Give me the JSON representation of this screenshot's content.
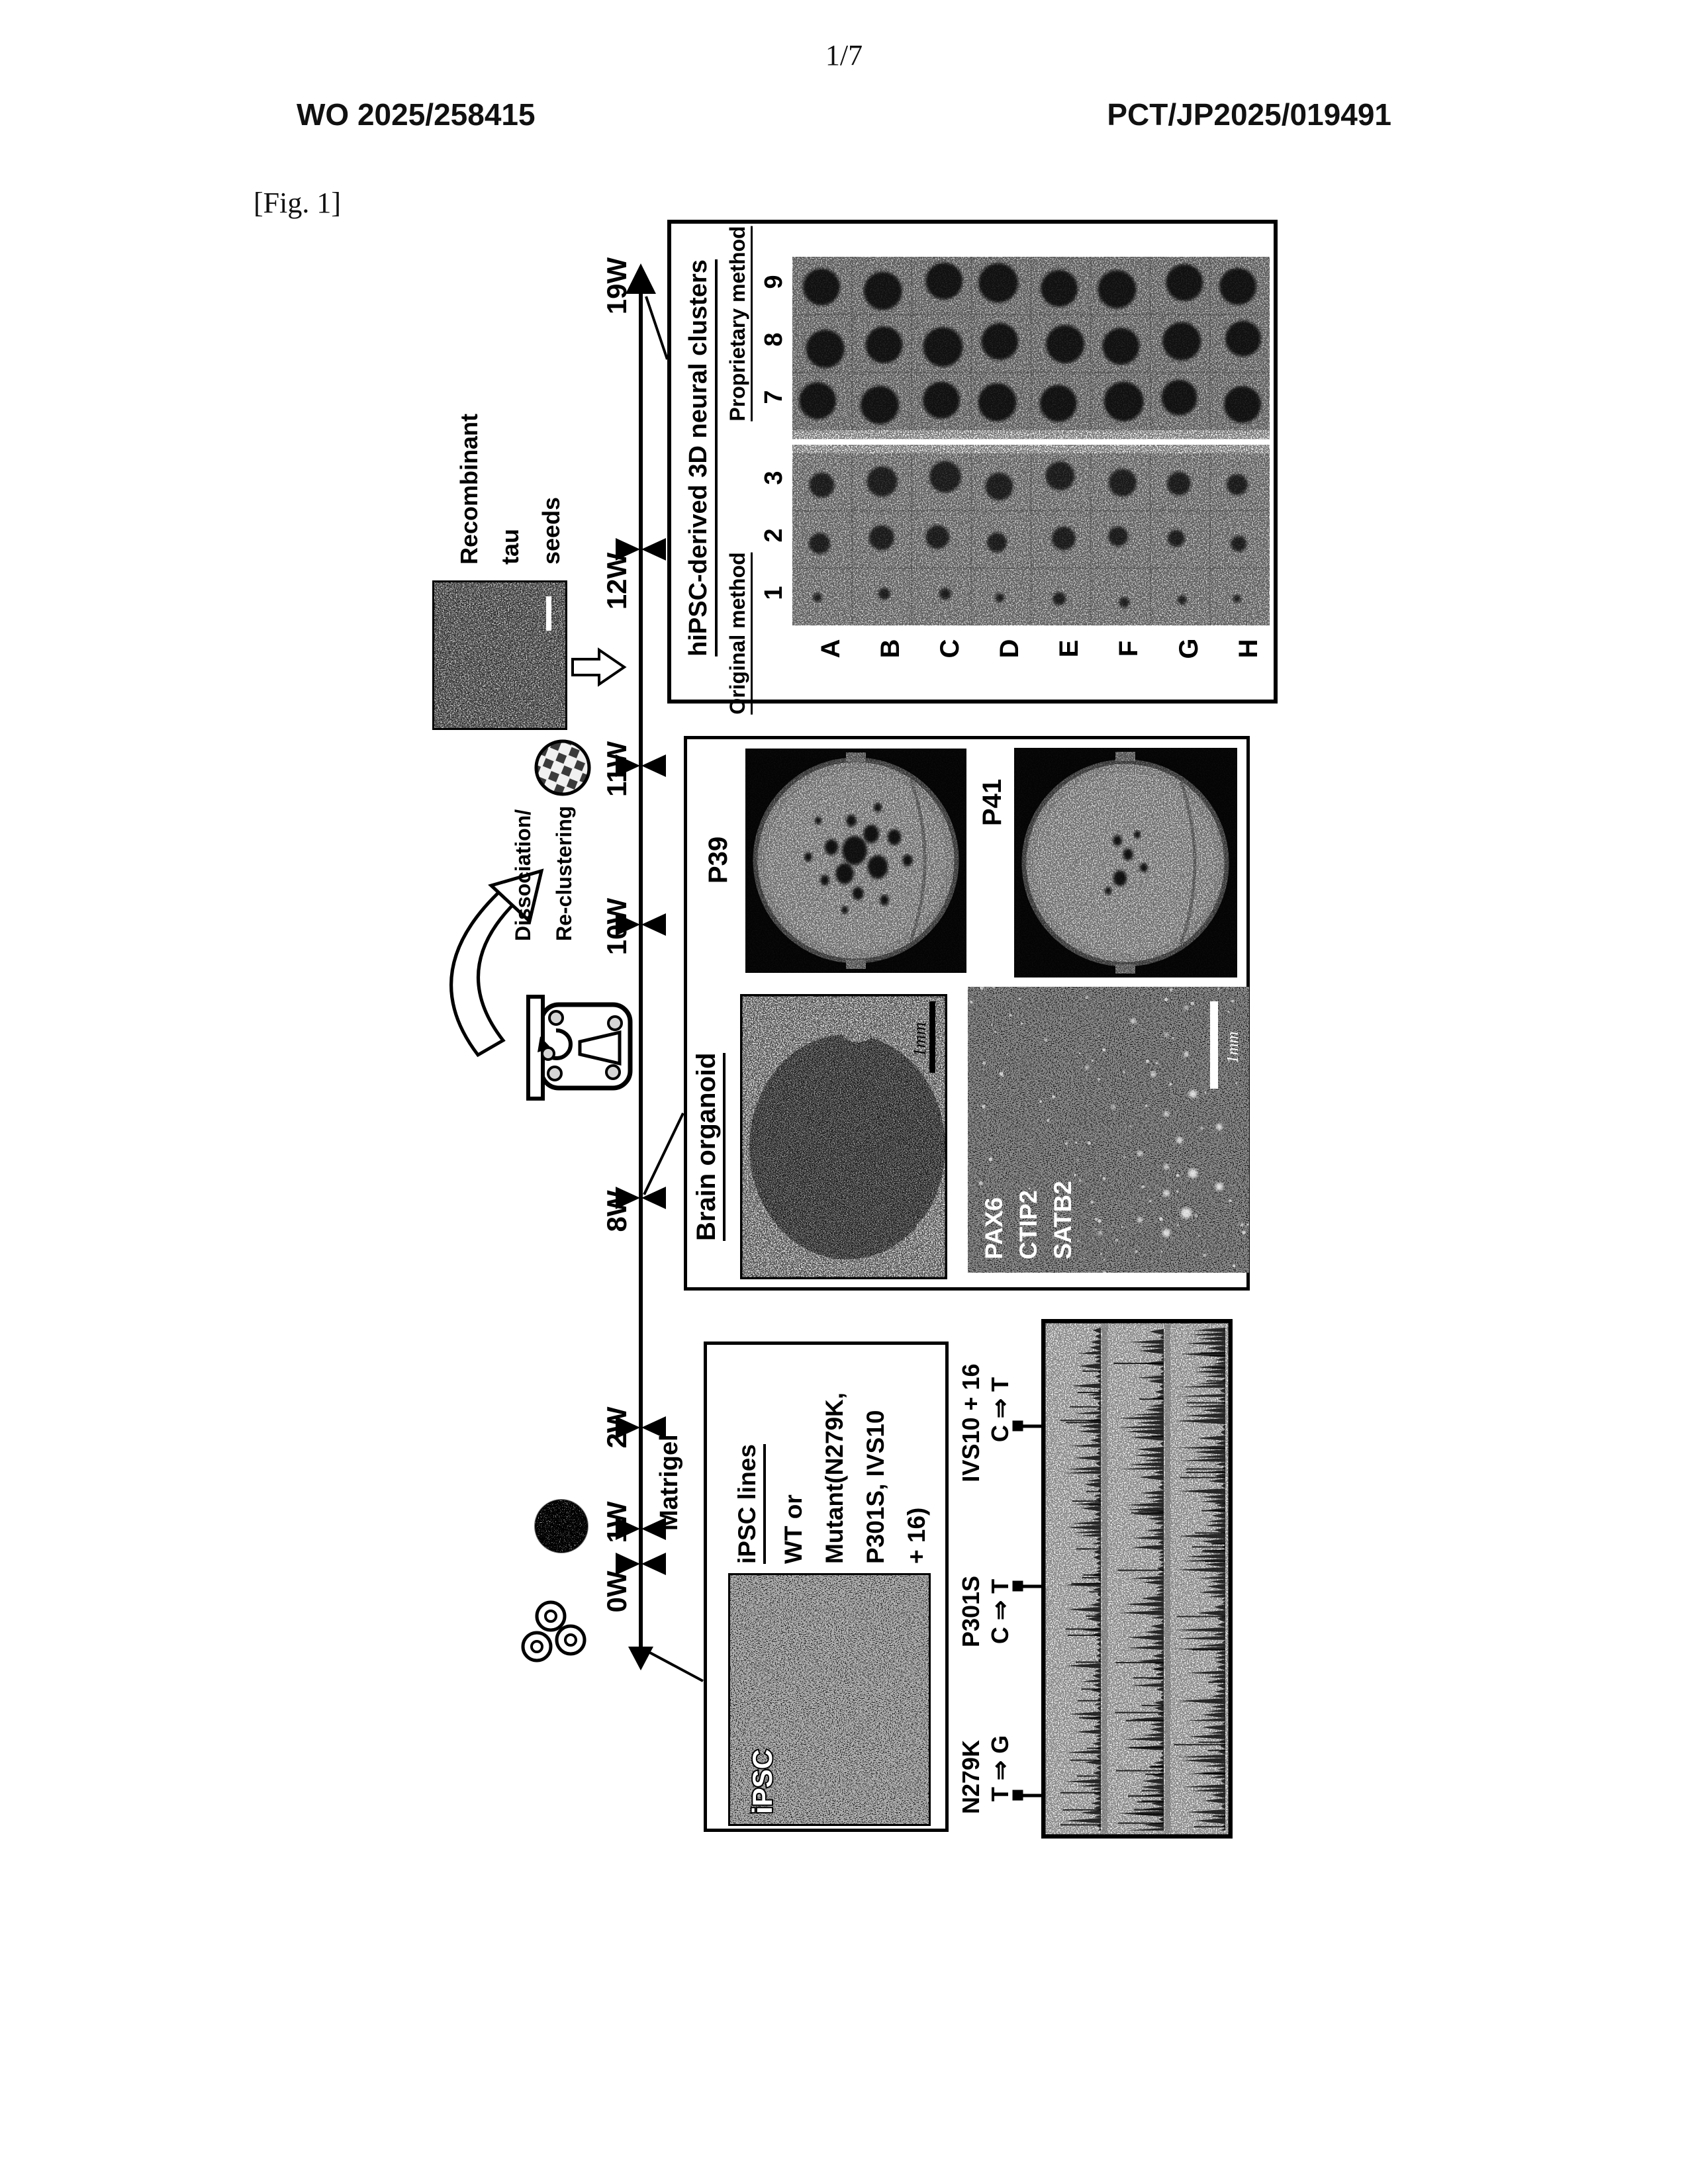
{
  "header": {
    "page_number": "1/7",
    "publication_number": "WO 2025/258415",
    "application_number": "PCT/JP2025/019491",
    "figure_label": "[Fig. 1]"
  },
  "timeline": {
    "week_labels": [
      "0W",
      "1W",
      "2W",
      "8W",
      "10W",
      "11W",
      "12W",
      "19W"
    ],
    "matrigel_label": "Matrigel"
  },
  "tau_seeds": {
    "line1": "Recombinant",
    "line2": "tau",
    "line3": "seeds"
  },
  "dissociation": {
    "line1": "Dissociation/",
    "line2": "Re-clustering"
  },
  "ipsc_box": {
    "title": "iPSC lines",
    "line1": "WT or",
    "line2": "Mutant(N279K,",
    "line3": "P301S, IVS10",
    "line4": "+ 16)",
    "image_label": "iPSC"
  },
  "sequencing": {
    "mutations": [
      {
        "name": "N279K",
        "change": "T ⇒ G"
      },
      {
        "name": "P301S",
        "change": "C ⇒ T"
      },
      {
        "name": "IVS10 + 16",
        "change": "C ⇒ T"
      }
    ]
  },
  "organoid_box": {
    "title": "Brain organoid",
    "dish1_label": "P39",
    "dish2_label": "P41",
    "if_labels": [
      "PAX6",
      "CTIP2",
      "SATB2"
    ],
    "scale_bar_label": "1mm"
  },
  "neural_box": {
    "title": "hiPSC-derived 3D neural clusters",
    "group1_label": "Original method",
    "group2_label": "Proprietary method",
    "group1_cols": [
      "1",
      "2",
      "3"
    ],
    "group2_cols": [
      "7",
      "8",
      "9"
    ],
    "row_labels": [
      "A",
      "B",
      "C",
      "D",
      "E",
      "F",
      "G",
      "H"
    ],
    "well_dot_radii_original": [
      [
        7,
        16,
        19
      ],
      [
        9,
        19,
        23
      ],
      [
        9,
        18,
        24
      ],
      [
        7,
        15,
        21
      ],
      [
        10,
        18,
        22
      ],
      [
        8,
        15,
        21
      ],
      [
        7,
        13,
        18
      ],
      [
        6,
        12,
        16
      ]
    ],
    "well_dot_radii_proprietary": [
      [
        28,
        29,
        28
      ],
      [
        29,
        28,
        29
      ],
      [
        28,
        30,
        28
      ],
      [
        29,
        28,
        30
      ],
      [
        28,
        29,
        28
      ],
      [
        30,
        28,
        29
      ],
      [
        27,
        29,
        28
      ],
      [
        28,
        27,
        28
      ]
    ]
  }
}
